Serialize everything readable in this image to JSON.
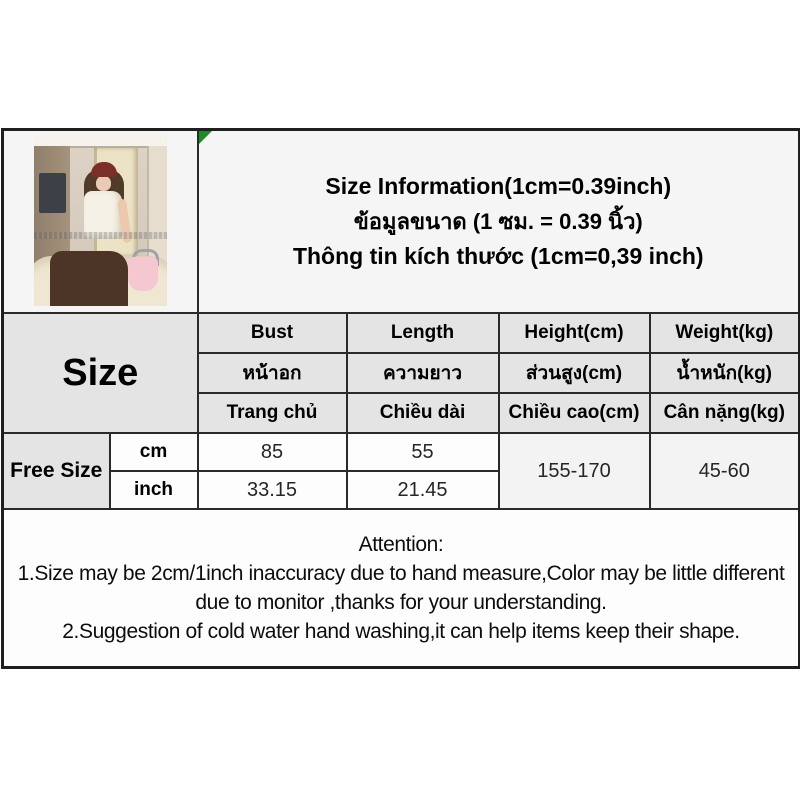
{
  "title": {
    "line_en": "Size Information(1cm=0.39inch)",
    "line_th": "ข้อมูลขนาด (1 ซม. = 0.39 นิ้ว)",
    "line_vi": "Thông tin kích thước (1cm=0,39 inch)"
  },
  "size_table": {
    "corner_label": "Size",
    "columns": [
      {
        "en": "Bust",
        "th": "หน้าอก",
        "vi": "Trang chủ"
      },
      {
        "en": "Length",
        "th": "ความยาว",
        "vi": "Chiều dài"
      },
      {
        "en": "Height(cm)",
        "th": "ส่วนสูง(cm)",
        "vi": "Chiều cao(cm)"
      },
      {
        "en": "Weight(kg)",
        "th": "น้ำหนัก(kg)",
        "vi": "Cân nặng(kg)"
      }
    ],
    "row_label": "Free Size",
    "units": {
      "metric": "cm",
      "imperial": "inch"
    },
    "values": {
      "bust_cm": "85",
      "bust_inch": "33.15",
      "length_cm": "55",
      "length_inch": "21.45",
      "height_range": "155-170",
      "weight_range": "45-60"
    }
  },
  "attention": {
    "heading": "Attention:",
    "note1": "1.Size may be 2cm/1inch inaccuracy due to hand measure,Color may be little different due to monitor ,thanks for your understanding.",
    "note2": "2.Suggestion of cold water hand washing,it can help items keep their shape."
  },
  "colors": {
    "header_bg": "#e4e4e4",
    "border": "#2a2a2a",
    "marker_green": "#1f8b1f"
  }
}
